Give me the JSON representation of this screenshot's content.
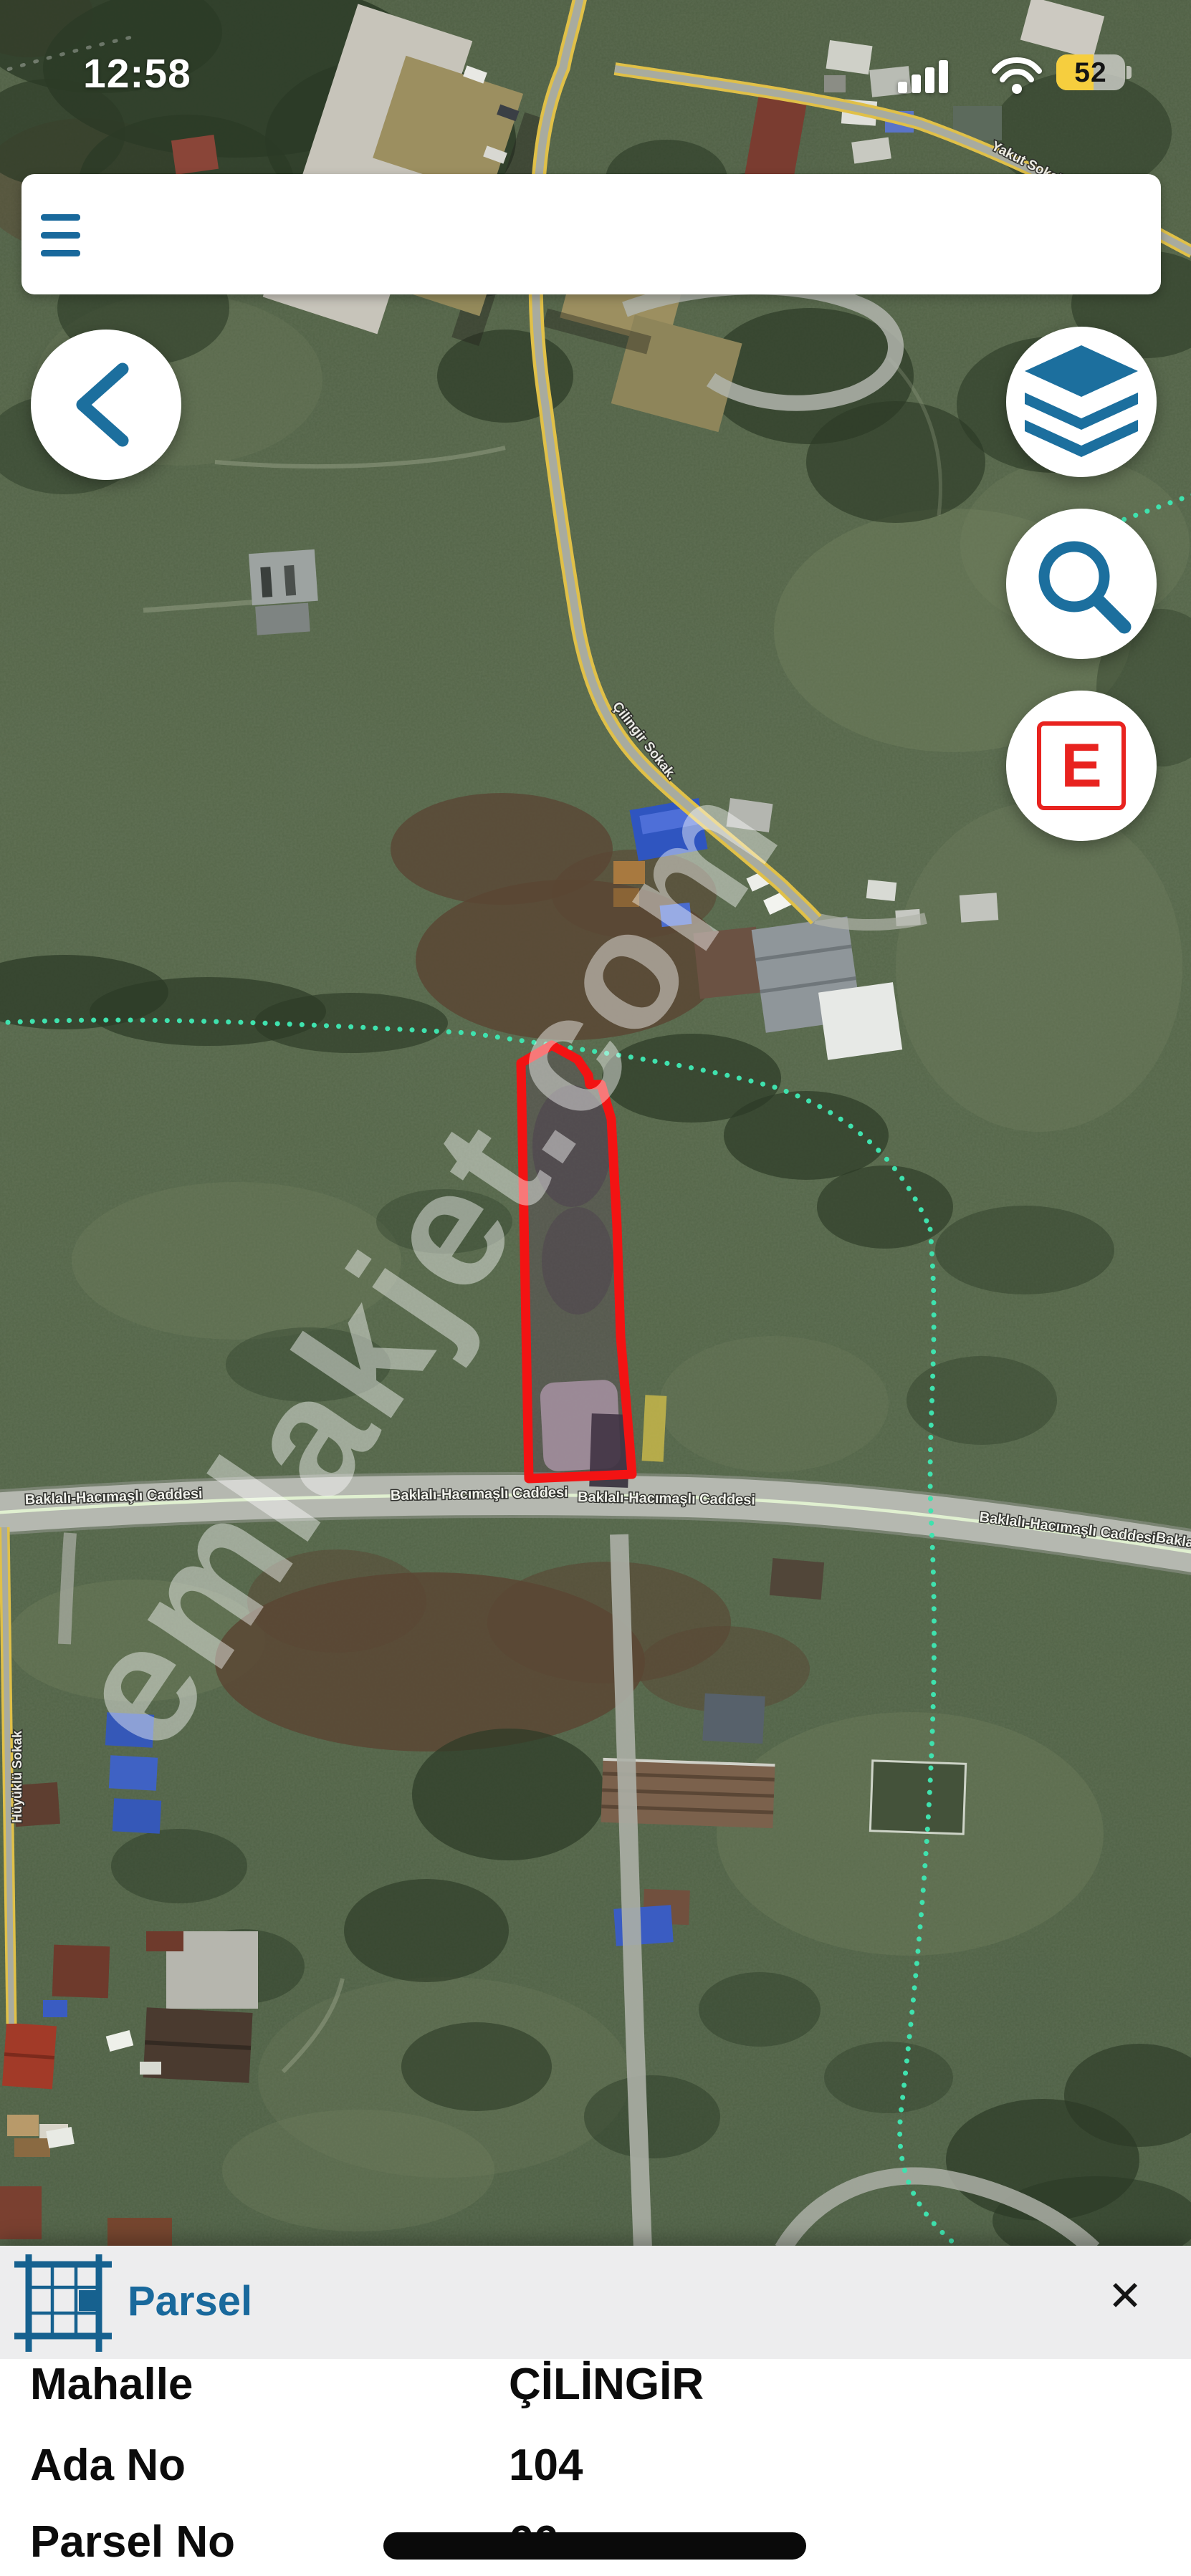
{
  "status_bar": {
    "time": "12:58",
    "battery_percent": "52"
  },
  "map": {
    "watermark": "emlakjet.com",
    "labels": {
      "main_road": "Baklalı-Hacımaşlı Caddesi",
      "diagonal_road": "Çilingir Sokak.",
      "top_right_road": "Yakut Sokak",
      "left_road": "Hüyüklü Sokak"
    },
    "parcel_outline_color": "#f31313",
    "boundary_line_color": "#3fe2ae",
    "accent_color": "#19699c"
  },
  "panel": {
    "title": "Parsel",
    "close": "✕",
    "rows": [
      {
        "label": "Mahalle",
        "value": "ÇİLİNGİR"
      },
      {
        "label": "Ada No",
        "value": "104"
      },
      {
        "label": "Parsel No",
        "value": "66"
      }
    ]
  }
}
